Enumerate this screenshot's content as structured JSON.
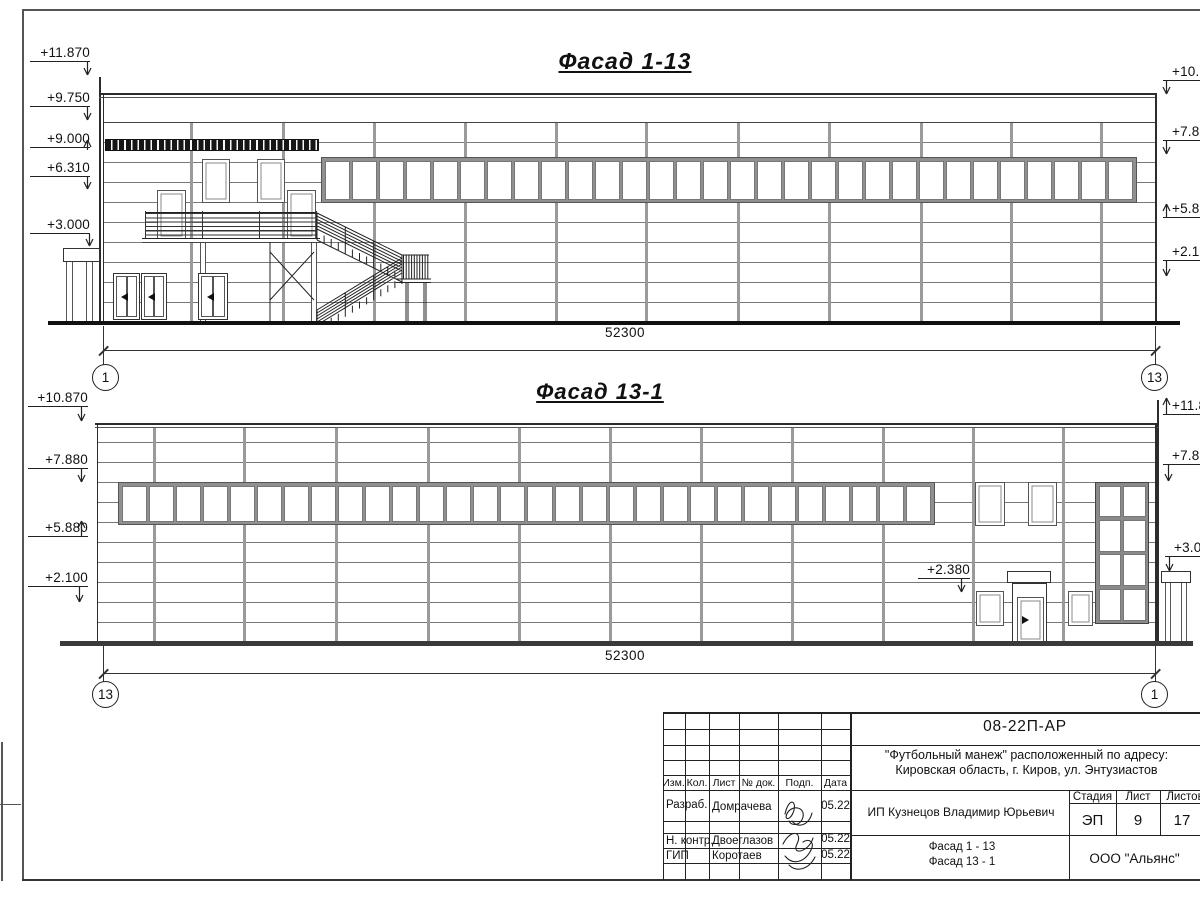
{
  "colors": {
    "ink": "#111111",
    "line_grey": "#787878",
    "frame": "#222222"
  },
  "facade1": {
    "title": "Фасад 1-13",
    "dimension": "52300",
    "axis_left": "1",
    "axis_right": "13",
    "levels_left": [
      "+11.870",
      "+9.750",
      "+9.000",
      "+6.310",
      "+3.000"
    ],
    "levels_right": [
      "+10.870",
      "+7.880",
      "+5.880",
      "+2.100"
    ]
  },
  "facade2": {
    "title": "Фасад 13-1",
    "dimension": "52300",
    "axis_left": "13",
    "axis_right": "1",
    "levels_left": [
      "+10.870",
      "+7.880",
      "+5.880",
      "+2.100"
    ],
    "levels_right": [
      "+11.870",
      "+7.880",
      "+3.000"
    ],
    "level_door": "+2.380"
  },
  "titleblock": {
    "doc_number": "08-22П-АР",
    "project_line1": "\"Футбольный манеж\" расположенный по адресу:",
    "project_line2": "Кировская область, г. Киров, ул. Энтузиастов",
    "client": "ИП Кузнецов Владимир Юрьевич",
    "stage_label": "Стадия",
    "sheet_label": "Лист",
    "sheets_label": "Листов",
    "stage": "ЭП",
    "sheet_no": "9",
    "sheets_total": "17",
    "sheet_title_line1": "Фасад 1 - 13",
    "sheet_title_line2": "Фасад 13 - 1",
    "company": "ООО \"Альянс\"",
    "col_izm": "Изм.",
    "col_kol": "Кол.",
    "col_list": "Лист",
    "col_ndok": "№ док.",
    "col_podp": "Подп.",
    "col_data": "Дата",
    "row1_role": "Разраб.",
    "row1_name": "Домрачева",
    "row1_date": "05.22",
    "row3_role": "Н. контр.",
    "row3_name": "Двоеглазов",
    "row3_date": "05.22",
    "row4_role": "ГИП",
    "row4_name": "Коротаев",
    "row4_date": "05.22"
  }
}
